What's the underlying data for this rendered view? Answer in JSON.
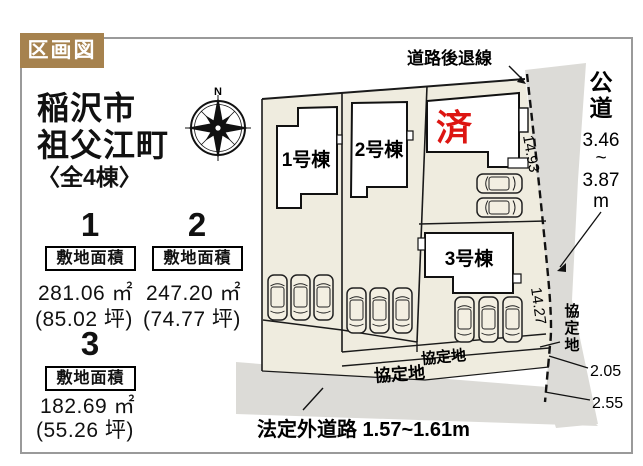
{
  "page": {
    "tag_label": "区画図",
    "title_line1": "稲沢市",
    "title_line2": "祖父江町",
    "title_line3": "〈全4棟〉"
  },
  "sections": [
    {
      "num": "1",
      "area_label": "敷地面積",
      "area_m2": "281.06 ㎡",
      "area_tsubo": "(85.02 坪)"
    },
    {
      "num": "2",
      "area_label": "敷地面積",
      "area_m2": "247.20 ㎡",
      "area_tsubo": "(74.77 坪)"
    },
    {
      "num": "3",
      "area_label": "敷地面積",
      "area_m2": "182.69 ㎡",
      "area_tsubo": "(55.26 坪)"
    }
  ],
  "diagram": {
    "compass_north": "N",
    "setback_line_label": "道路後退線",
    "building_1": "1号棟",
    "building_2": "2号棟",
    "building_3": "3号棟",
    "sold_label": "済",
    "public_road_char1": "公",
    "public_road_char2": "道",
    "public_road_width_min": "3.46",
    "public_road_tilde": "~",
    "public_road_width_max": "3.87",
    "public_road_unit": "m",
    "dim_east_upper": "14.93",
    "dim_east_lower": "14.27",
    "dim_strip_upper": "2.05",
    "dim_strip_lower": "2.55",
    "kyotei_small": "協定地",
    "kyotei_large": "協定地",
    "kyotei_v_char1": "協",
    "kyotei_v_char2": "定",
    "kyotei_v_char3": "地",
    "bottom_road_label": "法定外道路 1.57~1.61m"
  },
  "colors": {
    "tag_bg": "#a6824e",
    "plot_fill": "#efecdf",
    "road_fill": "#dcdbd7",
    "sold_red": "#dd1512",
    "outline": "#1a1a1a",
    "frame_border": "#9a9a9a"
  }
}
